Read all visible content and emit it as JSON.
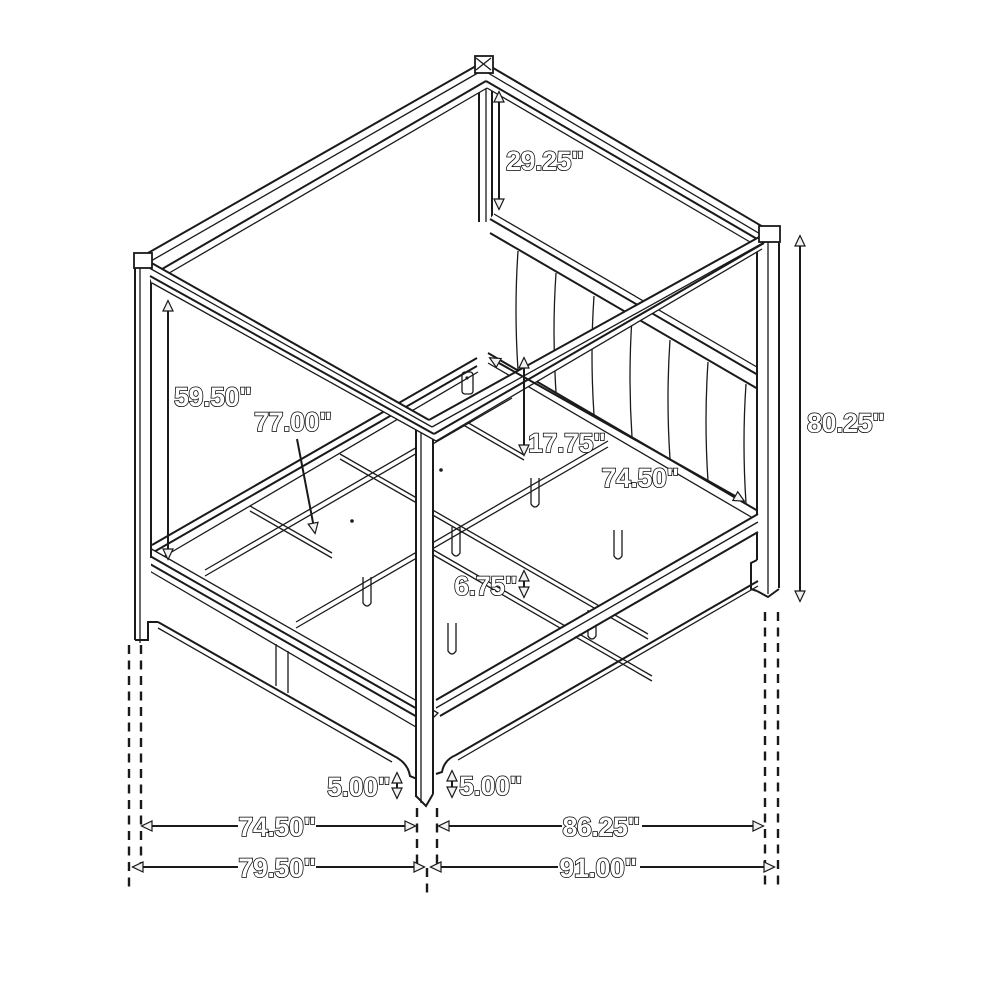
{
  "figure": {
    "kind": "isometric line drawing",
    "subject": "four-poster canopy bed with upholstered channel headboard, side rails and slat deck",
    "background_color": "#ffffff",
    "line_color": "#1a1a1a",
    "label_style": "outlined white bold numerals"
  },
  "annotations": [
    {
      "id": "canopy-post-above-headboard",
      "text": "29.25\"",
      "orientation": "vertical"
    },
    {
      "id": "canopy-underside-clearance",
      "text": "59.50\"",
      "orientation": "vertical"
    },
    {
      "id": "slat-width-callout",
      "text": "77.00\"",
      "orientation": "leader"
    },
    {
      "id": "headboard-bottom-to-deck",
      "text": "17.75\"",
      "orientation": "vertical"
    },
    {
      "id": "inner-width-upper",
      "text": "74.50\"",
      "orientation": "diagonal"
    },
    {
      "id": "overall-height",
      "text": "80.25\"",
      "orientation": "vertical"
    },
    {
      "id": "rail-to-slat-gap",
      "text": "6.75\"",
      "orientation": "vertical"
    },
    {
      "id": "front-leg-height-left",
      "text": "5.00\"",
      "orientation": "vertical"
    },
    {
      "id": "front-leg-height-right",
      "text": "5.00\"",
      "orientation": "vertical"
    },
    {
      "id": "inner-width-bottom",
      "text": "74.50\"",
      "orientation": "horizontal"
    },
    {
      "id": "inner-length-bottom",
      "text": "86.25\"",
      "orientation": "horizontal"
    },
    {
      "id": "overall-width-bottom",
      "text": "79.50\"",
      "orientation": "horizontal"
    },
    {
      "id": "overall-length-bottom",
      "text": "91.00\"",
      "orientation": "horizontal"
    }
  ]
}
